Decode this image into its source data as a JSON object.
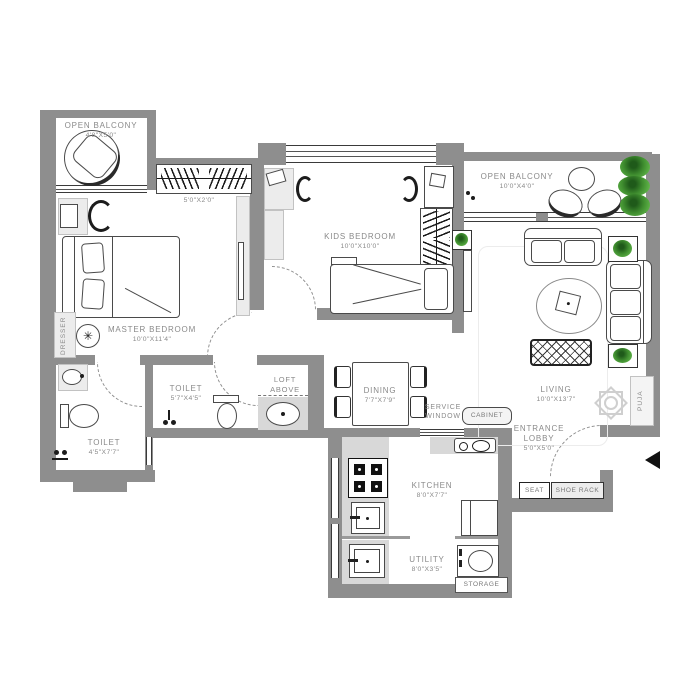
{
  "labels": {
    "balcony_left": {
      "name": "OPEN BALCONY",
      "dim": "4'8\"X5'0\""
    },
    "balcony_right": {
      "name": "OPEN BALCONY",
      "dim": "10'0\"X4'0\""
    },
    "master": {
      "name": "MASTER BEDROOM",
      "dim": "10'0\"X11'4\""
    },
    "kids": {
      "name": "KIDS BEDROOM",
      "dim": "10'0\"X10'0\""
    },
    "living": {
      "name": "LIVING",
      "dim": "10'0\"X13'7\""
    },
    "dining": {
      "name": "DINING",
      "dim": "7'7\"X7'9\""
    },
    "kitchen": {
      "name": "KITCHEN",
      "dim": "8'0\"X7'7\""
    },
    "utility": {
      "name": "UTILITY",
      "dim": "8'0\"X3'5\""
    },
    "toilet_common": {
      "name": "TOILET",
      "dim": "5'7\"X4'5\""
    },
    "toilet_master": {
      "name": "TOILET",
      "dim": "4'5\"X7'7\""
    },
    "lobby": {
      "l1": "ENTRANCE",
      "l2": "LOBBY",
      "dim": "5'0\"X5'0\""
    },
    "loft": {
      "l1": "LOFT",
      "l2": "ABOVE"
    },
    "service": {
      "l1": "SERVICE",
      "l2": "WINDOW"
    },
    "wardrobe_dim": "5'0\"X2'0\"",
    "cabinet": "CABINET",
    "storage": "STORAGE",
    "seat": "SEAT",
    "shoe_rack": "SHOE RACK",
    "puja": "PUJA",
    "dresser": "DRESSER"
  },
  "colors": {
    "wall": "#8e8e8e",
    "label": "#8a8a8a",
    "plant": "#3f8d2f"
  }
}
